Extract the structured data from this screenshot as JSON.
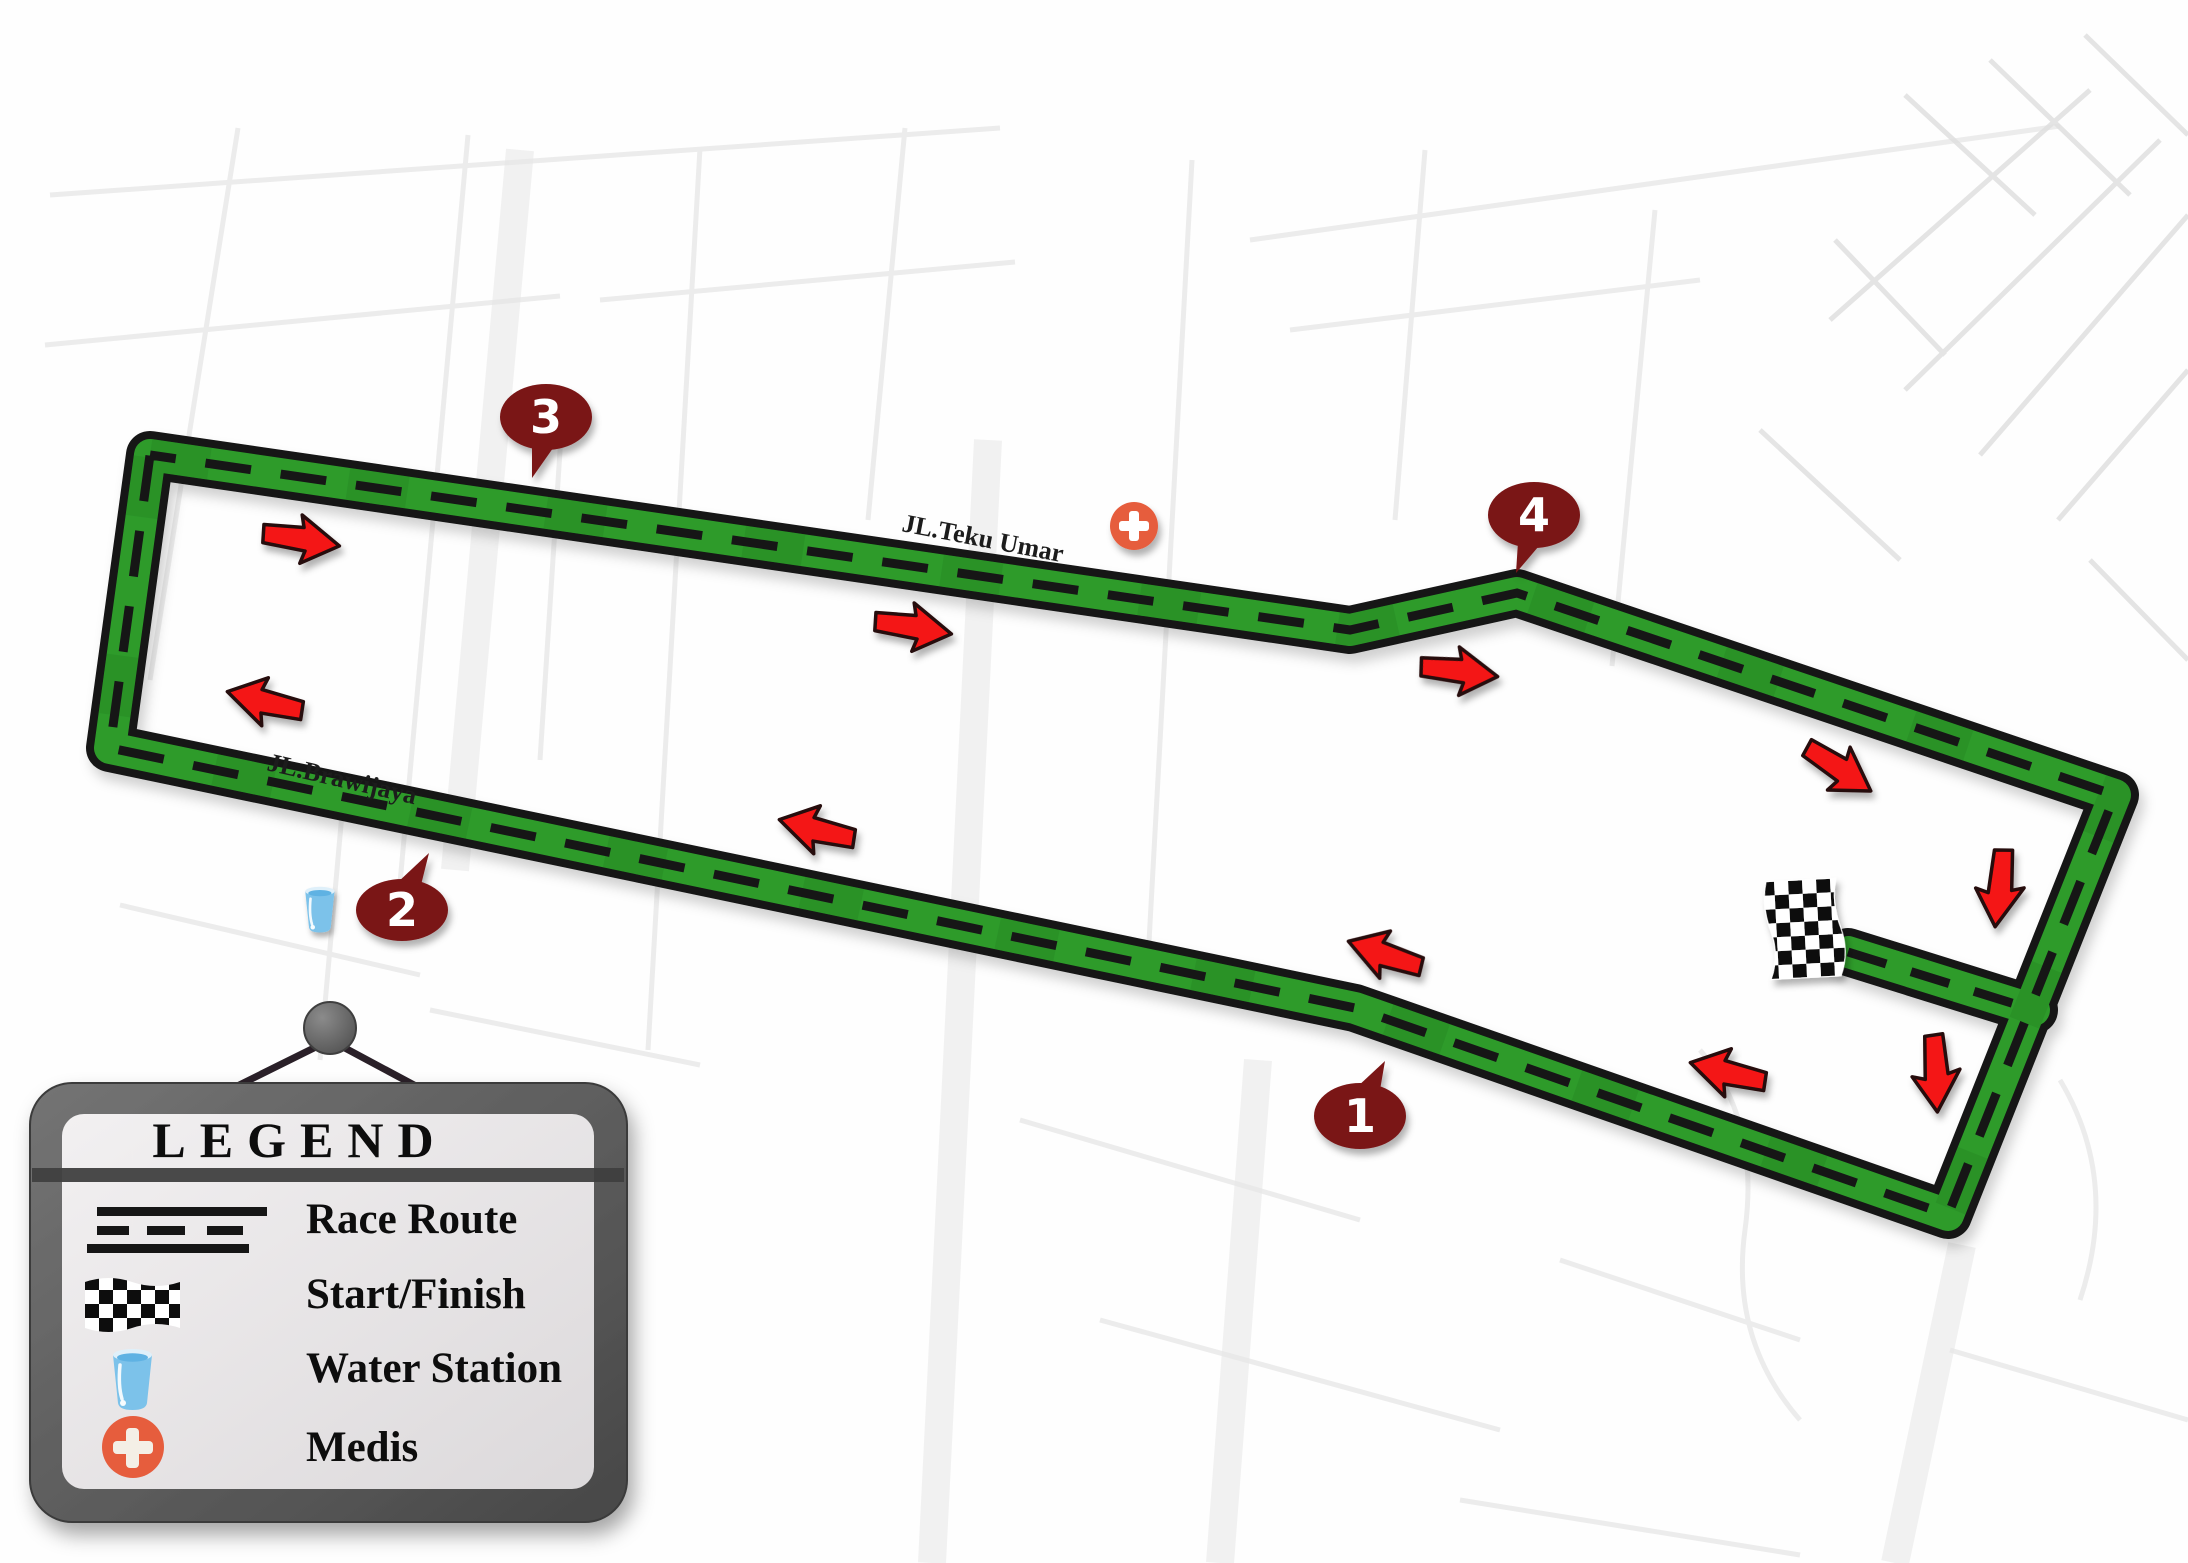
{
  "map": {
    "street_labels": [
      {
        "text": "JL.Teku Umar"
      },
      {
        "text": "JL.Brawijaya"
      }
    ],
    "markers": [
      {
        "number": "1"
      },
      {
        "number": "2"
      },
      {
        "number": "3"
      },
      {
        "number": "4"
      }
    ],
    "colors": {
      "route_green": "#2E9B2C",
      "route_casing": "#141414",
      "marker_maroon": "#7A1517",
      "arrow_red": "#F41414",
      "medic_orange": "#E65D3E",
      "water_blue": "#7CC2EA"
    }
  },
  "legend": {
    "title": "LEGEND",
    "items": [
      {
        "icon": "race-route-icon",
        "label": "Race Route"
      },
      {
        "icon": "checkered-flag-icon",
        "label": "Start/Finish"
      },
      {
        "icon": "water-cup-icon",
        "label": "Water Station"
      },
      {
        "icon": "medic-cross-icon",
        "label": "Medis"
      }
    ]
  }
}
